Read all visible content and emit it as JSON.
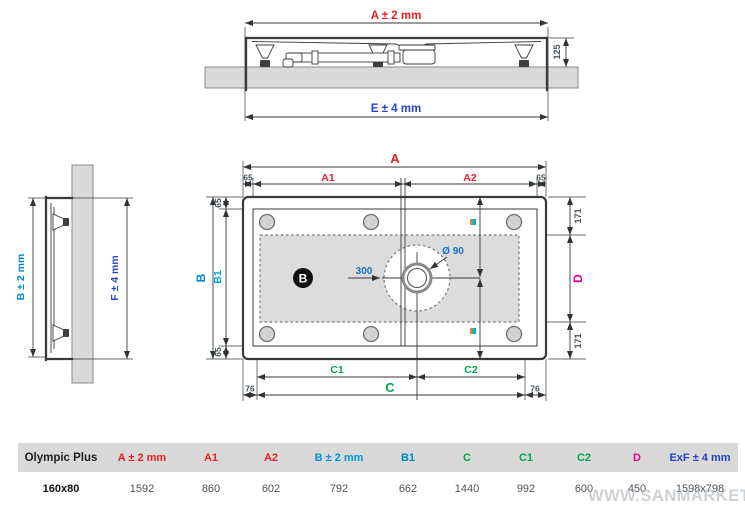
{
  "colors": {
    "red": "#ed1c24",
    "blue": "#0088cc",
    "cyan": "#00a5e0",
    "green": "#00a651",
    "magenta": "#ec008c",
    "navy": "#2742c8",
    "small_dims": "#45555f",
    "leader_blue": "#1a6fc4",
    "table_header_bg": "#d9d9d9",
    "drawing_fill": "#dcdcdc"
  },
  "views": {
    "elevation": {
      "dim_a": "A ± 2 mm",
      "dim_e": "E ± 4 mm",
      "dim_height": "125"
    },
    "side": {
      "dim_b": "B ± 2 mm",
      "dim_f": "F ± 4 mm"
    },
    "plan": {
      "dim_a": "A",
      "dim_a1": "A1",
      "dim_a2": "A2",
      "dim_b": "B",
      "dim_b1": "B1",
      "dim_c": "C",
      "dim_c1": "C1",
      "dim_c2": "C2",
      "dim_d": "D",
      "edge_65": "65",
      "edge_76": "76",
      "edge_171": "171",
      "drain_diameter": "Ø 90",
      "drain_offset": "300",
      "zone_badge": "B"
    }
  },
  "table": {
    "product_column": "Olympic Plus",
    "row_label": "160x80",
    "columns": [
      {
        "label": "A ± 2 mm",
        "color": "#ed1c24",
        "value": "1592"
      },
      {
        "label": "A1",
        "color": "#ed1c24",
        "value": "860"
      },
      {
        "label": "A2",
        "color": "#ed1c24",
        "value": "602"
      },
      {
        "label": "B ± 2 mm",
        "color": "#0095d9",
        "value": "792"
      },
      {
        "label": "B1",
        "color": "#0082c8",
        "value": "662"
      },
      {
        "label": "C",
        "color": "#00a651",
        "value": "1440"
      },
      {
        "label": "C1",
        "color": "#00a651",
        "value": "992"
      },
      {
        "label": "C2",
        "color": "#00a651",
        "value": "600"
      },
      {
        "label": "D",
        "color": "#ec008c",
        "value": "450"
      },
      {
        "label": "ExF ± 4 mm",
        "color": "#2742c8",
        "value": "1598x798"
      }
    ]
  },
  "watermark": "WWW.SANMARKET.RU"
}
